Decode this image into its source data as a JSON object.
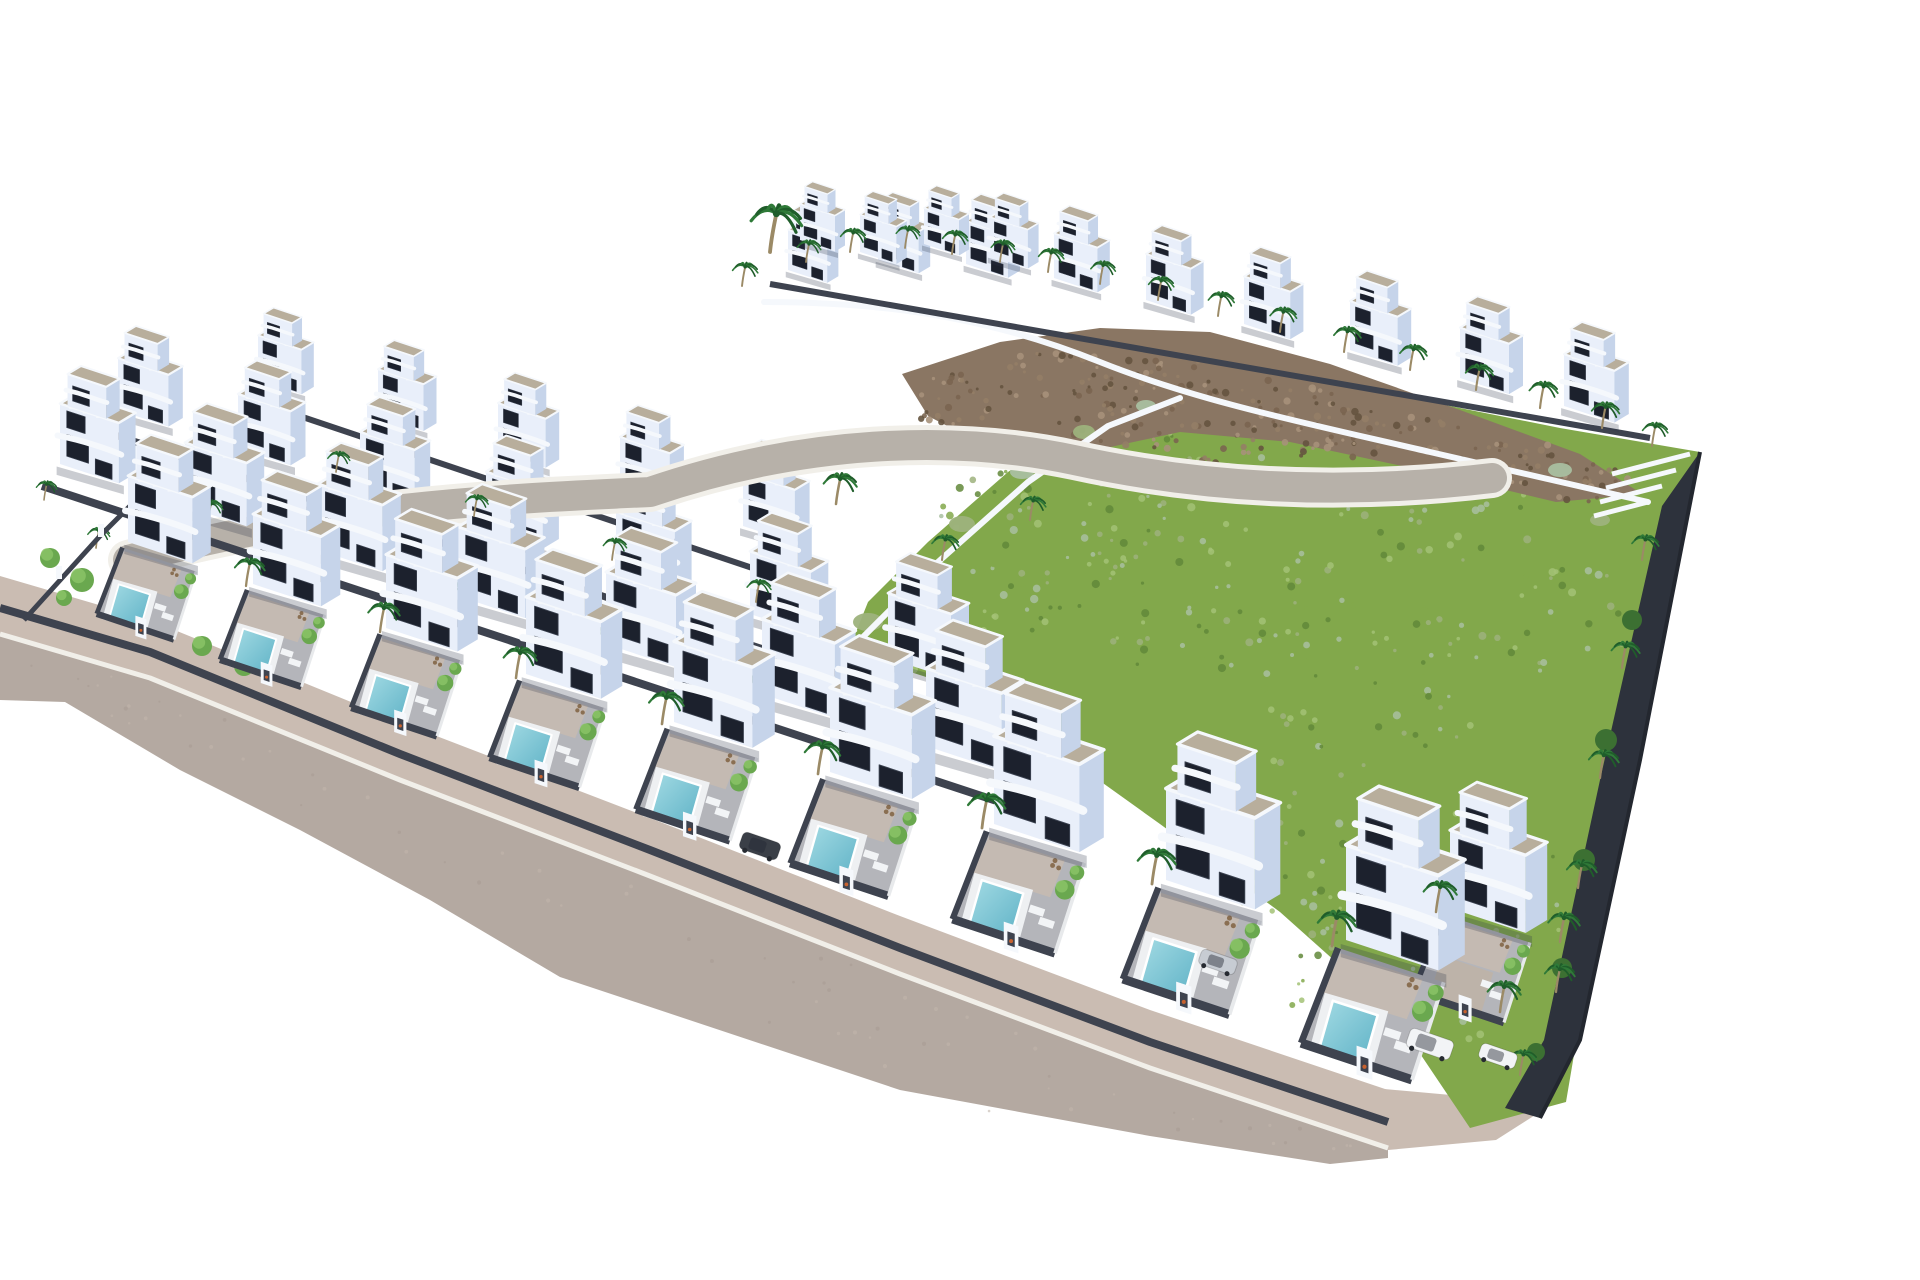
{
  "meta": {
    "type": "3d-architectural-aerial-render",
    "description": "Aerial 3D render of a hillside residential development: staggered rows of white modern cube villas with beige gravel roof decks, curved white balcony bands, dark window strips, private plunge pools behind dark grey yard walls with white gate pillars, palm trees throughout, a green scrub hillside with a brown rocky ridge on the right half, a curved internal street, a wide grey perimeter road along the lower-left edge, a dark planted boundary fence on the right, and four parked cars near the bottom-right corner. Pure white background.",
    "counts": {
      "villas": 38,
      "pools": 9,
      "palm_trees": 49,
      "round_trees": 26,
      "cars": 4,
      "gate_pillars": 10
    }
  },
  "palette": {
    "bg": "#ffffff",
    "facade": "#e9effa",
    "facade_side": "#c6d4ea",
    "window": "#1c212d",
    "window_frame": "#3a414f",
    "roof_gravel": "#b8ae9c",
    "parapet": "#f5f8fc",
    "wall_dark": "#3e434f",
    "wall_mid": "#6a7077",
    "floor_terrace": "#b4b5ba",
    "floor_warm": "#c7bbb0",
    "road": "#b4a9a1",
    "sidewalk": "#cabcb2",
    "curb": "#f1efe9",
    "inner_road": "#b7b1a9",
    "pool_light": "#a3dbe4",
    "pool_deep": "#5fb2c6",
    "grass": "#82a84b",
    "grass_dark": "#62883a",
    "grass_light": "#a3c276",
    "scrub": "#9db27c",
    "sage": "#a9bfa0",
    "rock": "#8a7663",
    "rock_dark": "#65543f",
    "rock_light": "#a6917a",
    "palm": "#2f7a38",
    "palm_dark": "#1f5d2a",
    "trunk": "#9b8a66",
    "tree": "#6aa84f",
    "tree_light": "#8cc468",
    "tree_dark": "#3c7032",
    "bed_dark": "#2d323c",
    "fence": "#23272f",
    "car_dark": "#3a3f47",
    "car_silver": "#c7ccd3",
    "car_white": "#f2f4f6",
    "shadow": "rgba(45,52,70,0.25)",
    "pot": "#c8622f",
    "roof_unit": "#9aa0a8",
    "deck_white": "#eef0f2",
    "driveway": "#bdb3a9",
    "yard_divider": "#e8eaec",
    "furniture": "#8a6f52"
  },
  "scene": {
    "canvas": {
      "w": 1920,
      "h": 1280
    },
    "road": {
      "top_edge": [
        [
          0,
          634
        ],
        [
          150,
          678
        ],
        [
          400,
          780
        ],
        [
          650,
          876
        ],
        [
          900,
          974
        ],
        [
          1150,
          1068
        ],
        [
          1388,
          1148
        ]
      ],
      "bottom_edge": [
        [
          1388,
          1158
        ],
        [
          1330,
          1164
        ],
        [
          1150,
          1136
        ],
        [
          900,
          1090
        ],
        [
          560,
          977
        ],
        [
          430,
          900
        ],
        [
          300,
          830
        ],
        [
          180,
          770
        ],
        [
          65,
          702
        ],
        [
          0,
          700
        ]
      ],
      "strip_offset": -58,
      "wall_path": "M0,608 L150,652 L400,754 L650,850 L900,948 L1150,1042 L1388,1122",
      "driveway": [
        [
          1150,
          1068
        ],
        [
          1462,
          1096
        ],
        [
          1540,
          1112
        ],
        [
          1496,
          1140
        ],
        [
          1388,
          1150
        ]
      ],
      "dot_count": 70
    },
    "inner_road": {
      "path": "M128,560 C320,506 520,498 650,492 C802,440 952,434 1074,460 C1202,488 1342,496 1492,478",
      "curb_w": 40,
      "surface_w": 30
    },
    "hill": {
      "poly": [
        [
          848,
          652
        ],
        [
          868,
          602
        ],
        [
          928,
          542
        ],
        [
          1008,
          472
        ],
        [
          1088,
          416
        ],
        [
          1178,
          386
        ],
        [
          1290,
          378
        ],
        [
          1420,
          400
        ],
        [
          1560,
          428
        ],
        [
          1700,
          452
        ],
        [
          1618,
          795
        ],
        [
          1566,
          1102
        ],
        [
          1470,
          1128
        ],
        [
          1392,
          1012
        ],
        [
          1280,
          912
        ],
        [
          1160,
          824
        ],
        [
          1040,
          738
        ],
        [
          948,
          684
        ]
      ],
      "wall_a": "M764,302 C900,302 1000,322 1100,362 C1200,402 1310,424 1430,452 L1648,502",
      "wall_b": "M850,650 L938,562 L1028,482 L1108,426 L1180,398",
      "grass_clusters": [
        [
          1060,
          520,
          120,
          70,
          55
        ],
        [
          1220,
          600,
          140,
          80,
          65
        ],
        [
          1380,
          680,
          130,
          80,
          55
        ],
        [
          1300,
          830,
          120,
          90,
          55
        ],
        [
          1460,
          900,
          110,
          90,
          50
        ],
        [
          1180,
          470,
          100,
          40,
          32
        ],
        [
          1420,
          520,
          120,
          50,
          36
        ],
        [
          1560,
          620,
          70,
          60,
          30
        ],
        [
          1360,
          980,
          90,
          70,
          36
        ],
        [
          1450,
          1000,
          60,
          45,
          24
        ],
        [
          1000,
          600,
          80,
          50,
          30
        ],
        [
          950,
          660,
          60,
          40,
          22
        ]
      ]
    },
    "rock": {
      "poly": [
        [
          902,
          374
        ],
        [
          1000,
          342
        ],
        [
          1100,
          328
        ],
        [
          1210,
          332
        ],
        [
          1330,
          364
        ],
        [
          1460,
          410
        ],
        [
          1580,
          454
        ],
        [
          1642,
          494
        ],
        [
          1556,
          502
        ],
        [
          1430,
          472
        ],
        [
          1290,
          442
        ],
        [
          1180,
          432
        ],
        [
          1078,
          454
        ],
        [
          988,
          447
        ],
        [
          928,
          416
        ]
      ],
      "clusters": [
        [
          960,
          400,
          60,
          26,
          30
        ],
        [
          1060,
          375,
          70,
          24,
          34
        ],
        [
          1170,
          380,
          70,
          26,
          34
        ],
        [
          1280,
          405,
          75,
          28,
          34
        ],
        [
          1390,
          435,
          75,
          28,
          32
        ],
        [
          1500,
          462,
          70,
          26,
          30
        ],
        [
          1590,
          482,
          50,
          20,
          24
        ],
        [
          1120,
          428,
          90,
          28,
          34
        ],
        [
          1240,
          444,
          80,
          24,
          28
        ]
      ]
    },
    "fence_right": {
      "bed_poly": [
        [
          1700,
          452
        ],
        [
          1640,
          760
        ],
        [
          1580,
          1040
        ],
        [
          1540,
          1118
        ],
        [
          1505,
          1108
        ],
        [
          1544,
          1040
        ],
        [
          1600,
          780
        ],
        [
          1662,
          506
        ]
      ],
      "line": "M1700,452 L1640,760 L1580,1040 L1540,1118",
      "stairs": [
        "M1612,474 L1690,454",
        "M1606,488 L1676,470",
        "M1600,502 L1662,486",
        "M1594,516 L1648,502"
      ],
      "bed_trees": [
        [
          1632,
          620,
          10
        ],
        [
          1606,
          740,
          11
        ],
        [
          1584,
          860,
          11
        ],
        [
          1562,
          968,
          10
        ],
        [
          1536,
          1052,
          9
        ]
      ],
      "palms": [
        [
          1642,
          560,
          0.85
        ],
        [
          1622,
          668,
          0.9
        ],
        [
          1600,
          778,
          0.95
        ],
        [
          1578,
          888,
          0.95
        ],
        [
          1556,
          992,
          0.95
        ],
        [
          1520,
          1075,
          0.85
        ]
      ]
    },
    "left_corner": {
      "fence": "M24,620 L100,536 L164,472",
      "posts": [
        [
          56,
          566
        ],
        [
          98,
          524
        ],
        [
          138,
          484
        ]
      ],
      "trees": [
        [
          50,
          558,
          10
        ],
        [
          82,
          580,
          12
        ],
        [
          118,
          602,
          11
        ],
        [
          160,
          624,
          12
        ],
        [
          202,
          646,
          10
        ],
        [
          64,
          598,
          8
        ],
        [
          244,
          666,
          10
        ]
      ]
    },
    "rows": {
      "summit": [
        [
          800,
          240,
          0.5
        ],
        [
          860,
          252,
          0.52
        ],
        [
          924,
          244,
          0.5
        ],
        [
          990,
          256,
          0.54
        ]
      ],
      "top": [
        [
          788,
          270,
          0.56
        ],
        [
          878,
          260,
          0.58
        ],
        [
          966,
          264,
          0.6
        ],
        [
          1054,
          278,
          0.62
        ],
        [
          1146,
          300,
          0.64
        ],
        [
          1244,
          324,
          0.66
        ],
        [
          1350,
          350,
          0.68
        ],
        [
          1460,
          378,
          0.7
        ],
        [
          1564,
          406,
          0.72
        ]
      ],
      "row4": [
        [
          258,
          380,
          0.62
        ],
        [
          378,
          416,
          0.65
        ],
        [
          498,
          452,
          0.68
        ],
        [
          620,
          488,
          0.71
        ],
        [
          743,
          526,
          0.74
        ]
      ],
      "row3": [
        [
          118,
          410,
          0.72
        ],
        [
          238,
          448,
          0.75
        ],
        [
          360,
          488,
          0.78
        ],
        [
          486,
          530,
          0.81
        ],
        [
          616,
          572,
          0.84
        ],
        [
          750,
          614,
          0.87
        ],
        [
          888,
          658,
          0.9
        ]
      ],
      "row2": [
        [
          60,
          464,
          0.84
        ],
        [
          185,
          506,
          0.88
        ],
        [
          318,
          550,
          0.92
        ],
        [
          458,
          596,
          0.96
        ],
        [
          606,
          644,
          1.0
        ],
        [
          762,
          694,
          1.04
        ],
        [
          926,
          746,
          1.08
        ]
      ],
      "front": [
        [
          128,
          542,
          0.92
        ],
        [
          253,
          584,
          0.97
        ],
        [
          386,
          628,
          1.02
        ],
        [
          526,
          674,
          1.07
        ],
        [
          674,
          722,
          1.12
        ],
        [
          830,
          772,
          1.17
        ],
        [
          994,
          824,
          1.22
        ],
        [
          1166,
          880,
          1.27
        ],
        [
          1450,
          908,
          1.08
        ],
        [
          1346,
          940,
          1.32
        ]
      ],
      "driveway_index": 8,
      "walls": {
        "top": "M770,284 L1650,438",
        "row4": "M240,396 L818,590",
        "row3": "M100,430 L972,718",
        "row2": "M42,486 L1030,812"
      }
    },
    "bushes": [
      [
        868,
        622,
        15,
        9
      ],
      [
        908,
        578,
        12,
        8
      ],
      [
        962,
        524,
        13,
        8
      ],
      [
        1022,
        472,
        12,
        7
      ],
      [
        1084,
        432,
        11,
        7
      ],
      [
        1146,
        406,
        10,
        6
      ],
      [
        856,
        660,
        17,
        10
      ],
      [
        1560,
        470,
        12,
        7
      ],
      [
        1600,
        520,
        10,
        6
      ]
    ],
    "palms": {
      "ridge": [
        [
          770,
          252,
          1.6
        ],
        [
          742,
          286,
          0.8
        ],
        [
          806,
          262,
          0.75
        ],
        [
          850,
          252,
          0.8
        ],
        [
          905,
          248,
          0.75
        ],
        [
          952,
          254,
          0.8
        ],
        [
          1000,
          262,
          0.75
        ],
        [
          1048,
          272,
          0.8
        ],
        [
          1100,
          284,
          0.78
        ],
        [
          1158,
          300,
          0.8
        ],
        [
          1218,
          316,
          0.82
        ],
        [
          1280,
          332,
          0.84
        ],
        [
          1344,
          352,
          0.86
        ],
        [
          1410,
          370,
          0.86
        ],
        [
          1476,
          390,
          0.88
        ],
        [
          1540,
          408,
          0.9
        ],
        [
          1602,
          428,
          0.88
        ],
        [
          1652,
          446,
          0.8
        ]
      ],
      "hill": [
        [
          802,
          472,
          1.1
        ],
        [
          836,
          504,
          1.05
        ],
        [
          942,
          560,
          0.85
        ],
        [
          1030,
          520,
          0.8
        ]
      ],
      "rows": [
        [
          336,
          472,
          0.7
        ],
        [
          474,
          516,
          0.72
        ],
        [
          612,
          560,
          0.74
        ],
        [
          756,
          602,
          0.76
        ],
        [
          302,
          562,
          0.8
        ],
        [
          448,
          606,
          0.82
        ],
        [
          592,
          652,
          0.85
        ],
        [
          748,
          702,
          0.88
        ],
        [
          906,
          756,
          0.9
        ],
        [
          208,
          522,
          0.75
        ],
        [
          96,
          548,
          0.7
        ],
        [
          44,
          500,
          0.65
        ]
      ],
      "front": [
        [
          246,
          586,
          0.95
        ],
        [
          380,
          632,
          1.0
        ],
        [
          516,
          678,
          1.05
        ],
        [
          662,
          724,
          1.1
        ],
        [
          818,
          774,
          1.12
        ],
        [
          982,
          828,
          1.18
        ],
        [
          1152,
          884,
          1.2
        ],
        [
          1332,
          946,
          1.2
        ],
        [
          1436,
          912,
          1.05
        ],
        [
          1560,
          942,
          1.0
        ],
        [
          1500,
          1012,
          1.05
        ]
      ]
    },
    "cars": [
      {
        "x": 760,
        "y": 846,
        "s": 1.0,
        "w": 40,
        "h": 18,
        "color": "car_dark"
      },
      {
        "x": 1218,
        "y": 962,
        "s": 0.95,
        "w": 40,
        "h": 17,
        "color": "car_silver"
      },
      {
        "x": 1430,
        "y": 1044,
        "s": 1.0,
        "w": 46,
        "h": 20,
        "color": "car_white"
      },
      {
        "x": 1498,
        "y": 1056,
        "s": 0.95,
        "w": 40,
        "h": 17,
        "color": "car_white"
      }
    ],
    "seed": 7
  }
}
